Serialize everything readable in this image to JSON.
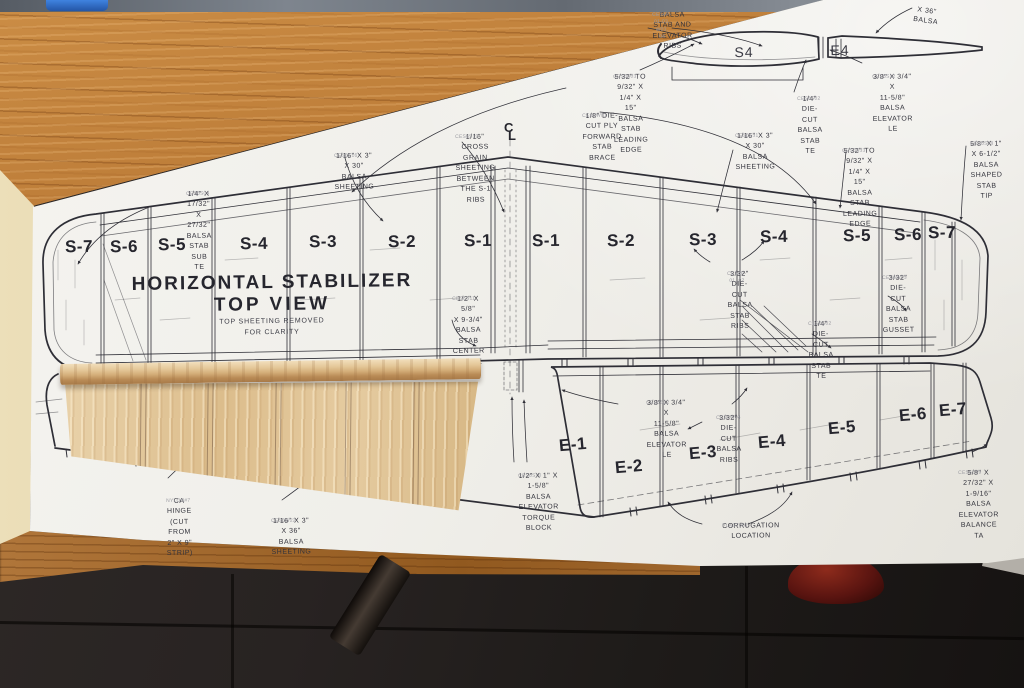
{
  "plan": {
    "title_line1": "HORIZONTAL STABILIZER",
    "title_line2": "TOP VIEW",
    "title_note": "TOP SHEETING REMOVED\nFOR CLARITY",
    "centerline": {
      "c": "C",
      "l": "L"
    },
    "side_view": {
      "stab_label": "S4",
      "elevator_label": "E4"
    },
    "stab_sections_left": [
      "S-7",
      "S-6",
      "S-5",
      "S-4",
      "S-3",
      "S-2",
      "S-1"
    ],
    "stab_sections_right": [
      "S-1",
      "S-2",
      "S-3",
      "S-4",
      "S-5",
      "S-6",
      "S-7"
    ],
    "elevator_sections": [
      "E-1",
      "E-2",
      "E-3",
      "E-4",
      "E-5",
      "E-6",
      "E-7"
    ],
    "annotations": [
      {
        "id": "stab-elevator-ribs",
        "text": "BALSA STAB AND\nELEVATOR RIBS",
        "part_no": "CES6P-01-03, W03, 04"
      },
      {
        "id": "x36-partial",
        "text": "X 36\" BALSA",
        "part_no": ""
      },
      {
        "id": "stab-le-left",
        "text": "5/32\" TO 9/32\" X 1/4\" X 15\"\nBALSA STAB LEADING EDGE",
        "part_no": "CES6S03"
      },
      {
        "id": "fwd-stab-brace",
        "text": "1/8\" DIE-CUT PLY\nFORWARD STAB BRACE",
        "part_no": "CES6W01"
      },
      {
        "id": "stab-te-sideview",
        "text": "1/4\" DIE-CUT\nBALSA\nSTAB TE",
        "part_no": "CES6S02"
      },
      {
        "id": "elevator-le-sideview",
        "text": "3/8\" X 3/4\" X\n11-5/8\" BALSA\nELEVATOR LE",
        "part_no": "CES6S12"
      },
      {
        "id": "cross-grain-sheeting",
        "text": "1/16\" CROSS GRAIN\nSHEETING BETWEEN\nTHE S-1 RIBS",
        "part_no": "CES6S19"
      },
      {
        "id": "sheeting-30-left",
        "text": "1/16\" X 3\" X 30\"\nBALSA SHEETING",
        "part_no": "CES6S16"
      },
      {
        "id": "sheeting-30-right",
        "text": "1/16\" X 3\" X 30\"\nBALSA SHEETING",
        "part_no": "CES6S31"
      },
      {
        "id": "stab-le-right",
        "text": "5/32\" TO 9/32\" X 1/4\" X 15\"\nBALSA STAB LEADING EDGE",
        "part_no": "CES6S33"
      },
      {
        "id": "stab-tip",
        "text": "5/8\" X 1\" X 6-1/2\"\nBALSA SHAPED\nSTAB TIP",
        "part_no": "CES6S08"
      },
      {
        "id": "stab-sub-te",
        "text": "1/4\" X 17/32\" X 27/32\"\nBALSA STAB SUB TE",
        "part_no": "CES6S04"
      },
      {
        "id": "stab-center-brace",
        "text": "1/2\" X 5/8\"\nX 9-3/4\" BALSA\nSTAB CENTER\nBRACE",
        "part_no": "CES6S11"
      },
      {
        "id": "stab-ribs",
        "text": "3/32\" DIE-CUT\nBALSA STAB\nRIBS",
        "part_no": "CES6P-01, 02"
      },
      {
        "id": "stab-gusset",
        "text": "3/32\" DIE-CUT\nBALSA STAB\nGUSSET",
        "part_no": "CES6W03"
      },
      {
        "id": "stab-te-right",
        "text": "1/4\" DIE-CUT\nBALSA\nSTAB TE",
        "part_no": "CES6S02"
      },
      {
        "id": "elevator-le",
        "text": "3/8\" X 3/4\" X\n11-5/8\" BALSA\nELEVATOR LE",
        "part_no": "CES6S12"
      },
      {
        "id": "elevator-ribs",
        "text": "3/32\" DIE-CUT\nBALSA RIBS",
        "part_no": "CES6W04"
      },
      {
        "id": "torque-block",
        "text": "1/2\" X 1\" X 1-5/8\"\nBALSA ELEVATOR\nTORQUE BLOCK",
        "part_no": "CES6S10"
      },
      {
        "id": "corrugation",
        "text": "CORRUGATION\nLOCATION",
        "part_no": "PLAST001"
      },
      {
        "id": "balance-tab",
        "text": "5/8\" X 27/32\" X 1-9/16\"\nBALSA ELEVATOR BALANCE TA",
        "part_no": "CES6S09"
      },
      {
        "id": "ca-hinge",
        "text": "CA HINGE\n(CUT FROM\n2\" X 9\" STRIP)",
        "part_no": "NYLON#7"
      },
      {
        "id": "sheeting-36",
        "text": "1/16\" X 3\" X 36\"\nBALSA SHEETING",
        "part_no": "CES6W22"
      }
    ]
  }
}
